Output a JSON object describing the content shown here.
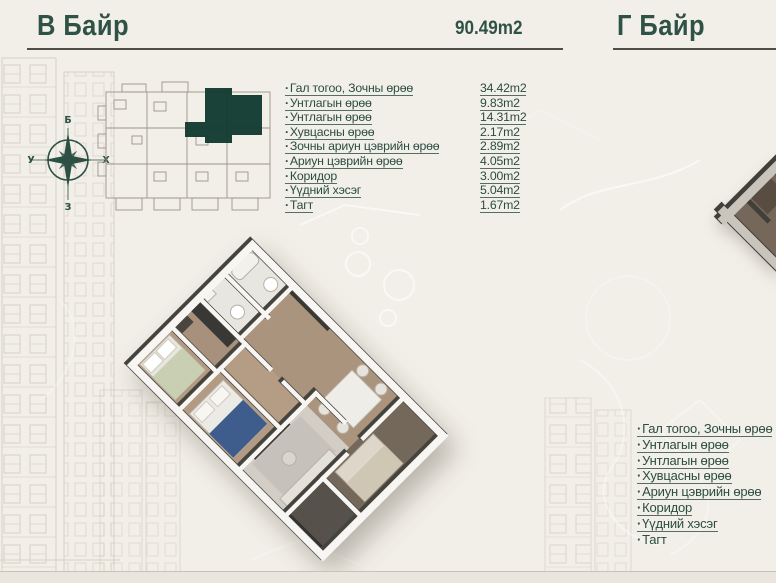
{
  "colors": {
    "background": "#f2efe8",
    "accent_teal": "#2f5247",
    "keyplan_highlight": "#123a31",
    "rule_grey": "#504e46"
  },
  "section_b": {
    "title": "В Байр",
    "total_area": "90.49m2",
    "rooms": [
      {
        "label": "Гал тогоо, Зочны өрөө",
        "area": "34.42m2"
      },
      {
        "label": "Унтлагын өрөө",
        "area": "9.83m2"
      },
      {
        "label": "Унтлагын өрөө",
        "area": "14.31m2"
      },
      {
        "label": "Хувцасны өрөө",
        "area": "2.17m2"
      },
      {
        "label": "Зочны ариун цэврийн өрөө",
        "area": "2.89m2"
      },
      {
        "label": "Ариун цэврийн өрөө",
        "area": "4.05m2"
      },
      {
        "label": "Коридор",
        "area": "3.00m2"
      },
      {
        "label": "Үүдний хэсэг",
        "area": "5.04m2"
      },
      {
        "label": "Тагт",
        "area": "1.67m2"
      }
    ]
  },
  "section_g": {
    "title": "Г Байр",
    "rooms": [
      {
        "label": "Гал тогоо, Зочны өрөө"
      },
      {
        "label": "Унтлагын өрөө"
      },
      {
        "label": "Унтлагын өрөө"
      },
      {
        "label": "Хувцасны өрөө"
      },
      {
        "label": "Ариун цэврийн өрөө"
      },
      {
        "label": "Коридор"
      },
      {
        "label": "Үүдний хэсэг"
      },
      {
        "label": "Тагт"
      }
    ]
  },
  "compass": {
    "top": "Б",
    "right": "Х",
    "bottom": "З",
    "left": "У"
  }
}
